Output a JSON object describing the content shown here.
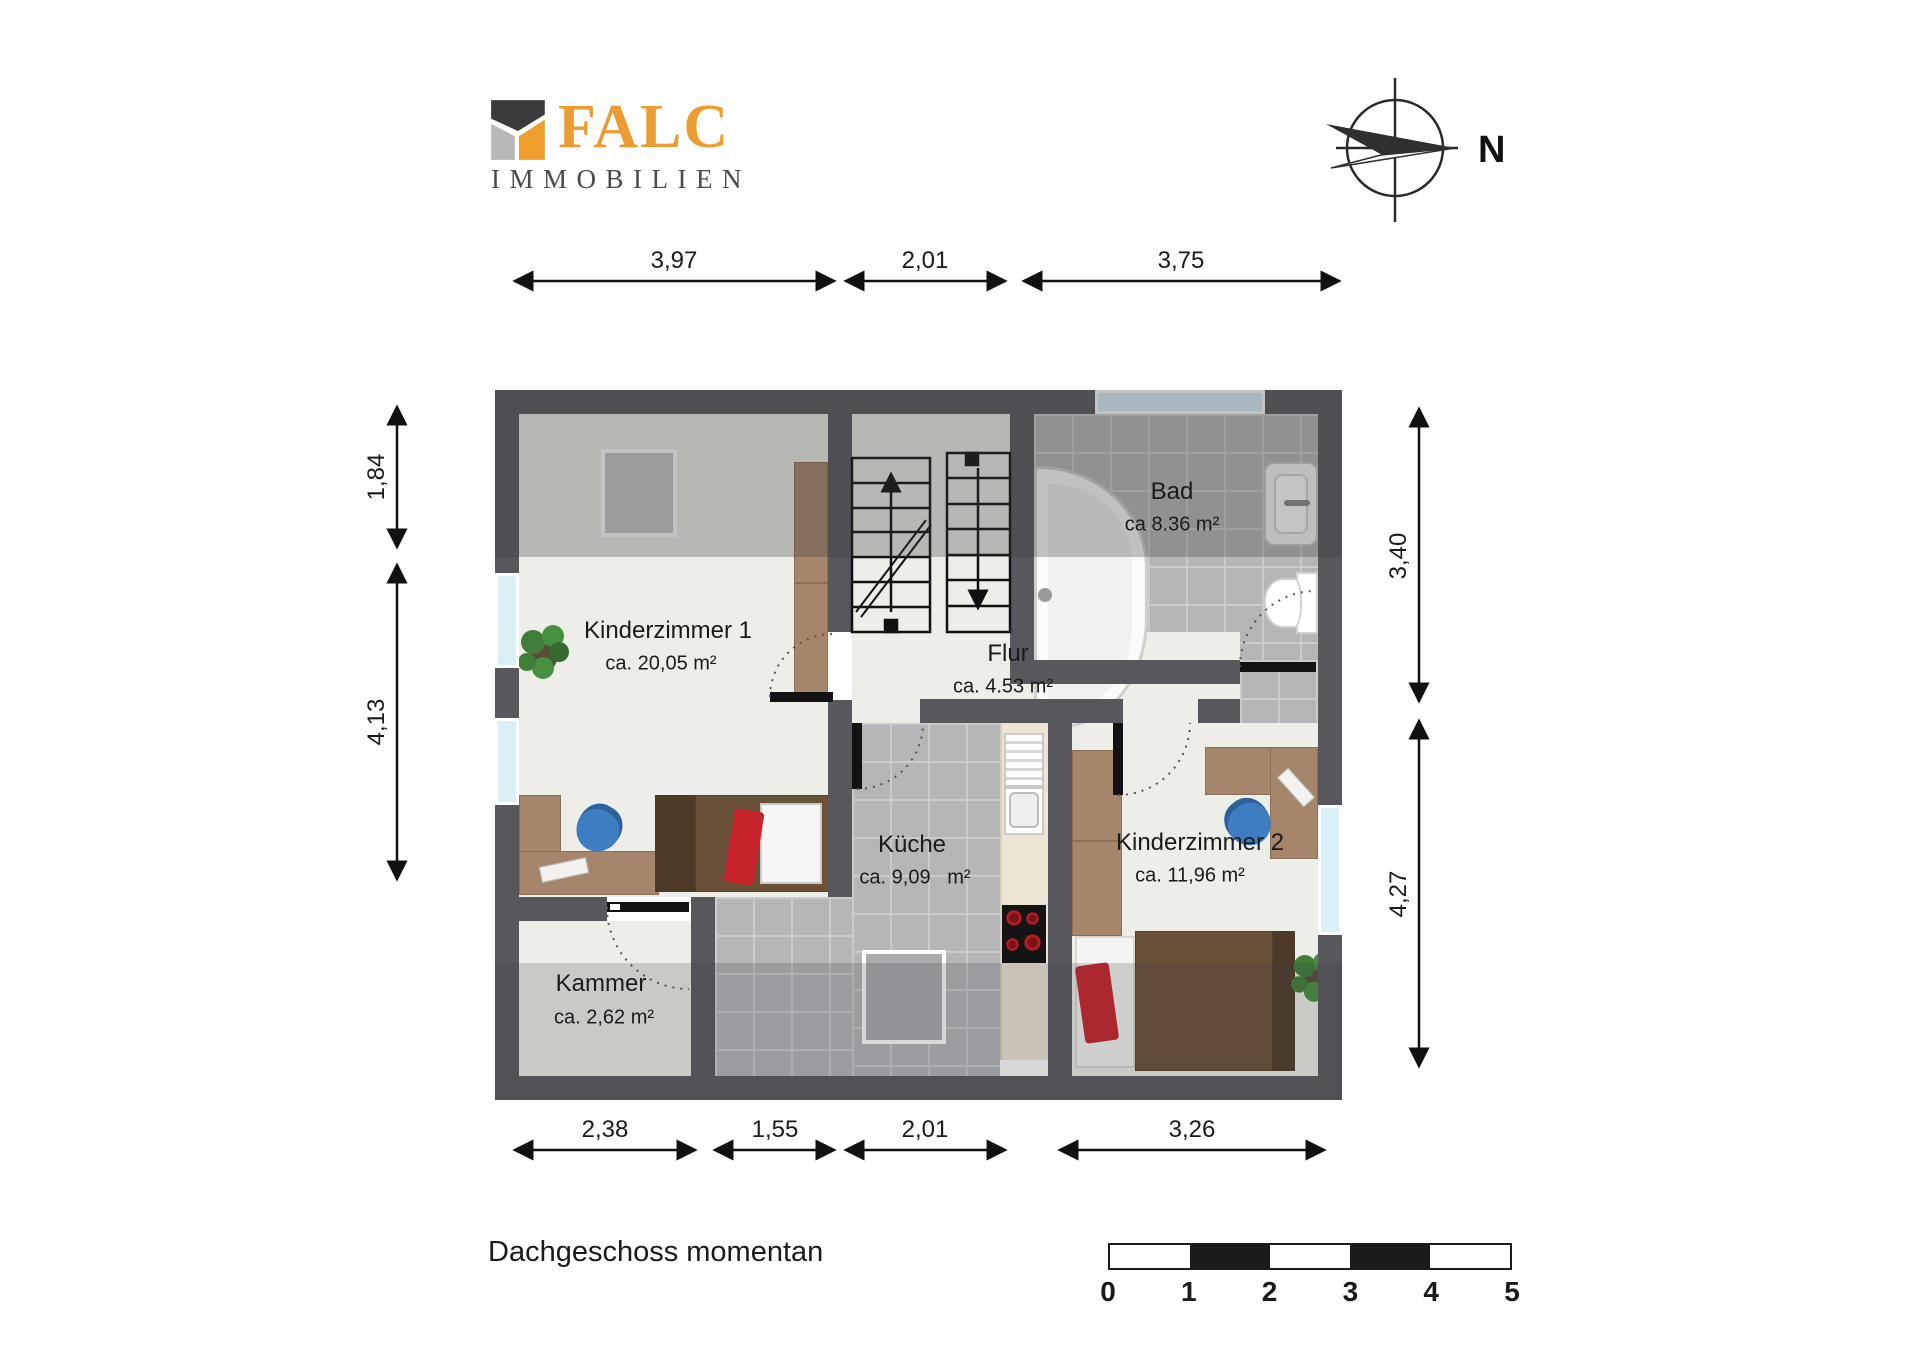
{
  "logo": {
    "line1": "FALC",
    "line2": "IMMOBILIEN"
  },
  "compass": {
    "label": "N"
  },
  "title": "Dachgeschoss momentan",
  "rooms": [
    {
      "name": "Kinderzimmer 1",
      "area": "ca. 20,05 m²"
    },
    {
      "name": "Bad",
      "area": "ca 8.36 m²"
    },
    {
      "name": "Flur",
      "area": "ca. 4.53 m²"
    },
    {
      "name": "Küche",
      "area": "ca. 9,09   m²"
    },
    {
      "name": "Kinderzimmer 2",
      "area": "ca. 11,96 m²"
    },
    {
      "name": "Kammer",
      "area": "ca. 2,62 m²"
    }
  ],
  "dimensions": {
    "top": [
      "3,97",
      "2,01",
      "3,75"
    ],
    "left": [
      "1,84",
      "4,13"
    ],
    "right": [
      "3,40",
      "4,27"
    ],
    "bottom": [
      "2,38",
      "1,55",
      "2,01",
      "3,26"
    ]
  },
  "scale_bar": {
    "ticks": [
      "0",
      "1",
      "2",
      "3",
      "4",
      "5"
    ]
  },
  "colors": {
    "brand_orange": "#ED9B33",
    "logo_gray": "#4B4B4D",
    "wall": "#58585C",
    "floor": "#EDEEE7",
    "tile": "#B4B6B8",
    "grout": "#C9CBCC",
    "counter": "#ECE5D3",
    "wood": "#A5866A",
    "bed_brown": "#6A5138",
    "bed_dark": "#4C3A27",
    "accent_red": "#C8242B",
    "chair_blue": "#3D7EC2",
    "glass": "#D8F0F6",
    "plant_green": "#3F7D38"
  }
}
